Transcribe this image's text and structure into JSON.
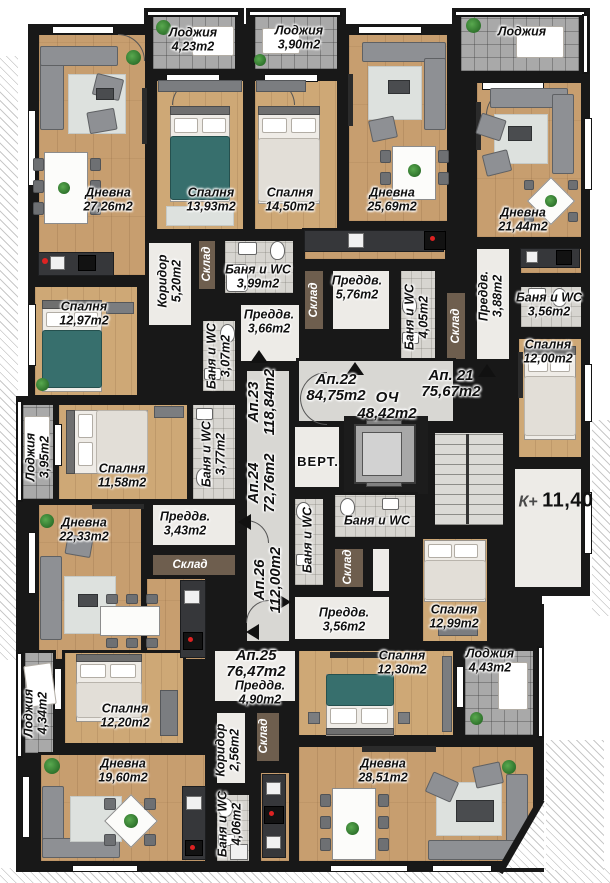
{
  "level": {
    "prefix": "К+",
    "value": "11,40"
  },
  "rooms": [
    {
      "name": "Лоджия",
      "area": "4,23m2"
    },
    {
      "name": "Дневна",
      "area": "27,26m2"
    },
    {
      "name": "Спалня",
      "area": "13,93m2"
    },
    {
      "name": "Спалня",
      "area": "14,50m2"
    },
    {
      "name": "Лоджия",
      "area": "3,90m2"
    },
    {
      "name": "Дневна",
      "area": "25,69m2"
    },
    {
      "name": "Лоджия"
    },
    {
      "name": "Дневна",
      "area": "21,44m2"
    },
    {
      "name": "Спалня",
      "area": "12,97m2"
    },
    {
      "name": "Коридор",
      "area": "5,20m2"
    },
    {
      "name": "Склад"
    },
    {
      "name": "Баня и WC",
      "area": "3,99m2"
    },
    {
      "name": "Преддв.",
      "area": "3,66m2"
    },
    {
      "name": "Баня и WC",
      "area": "3,07m2"
    },
    {
      "name": "Преддв.",
      "area": "5,76m2"
    },
    {
      "name": "Склад"
    },
    {
      "name": "Баня и WC",
      "area": "4,05m2"
    },
    {
      "name": "Склад"
    },
    {
      "name": "Преддв.",
      "area": "3,88m2"
    },
    {
      "name": "Баня и WC",
      "area": "3,56m2"
    },
    {
      "name": "Спалня",
      "area": "12,00m2"
    },
    {
      "name": "Ап.22",
      "area": "84,75m2"
    },
    {
      "name": "ОЧ",
      "area": "48,42m2"
    },
    {
      "name": "Ап. 21",
      "area": "75,67m2"
    },
    {
      "name": "Ап.23",
      "area": "118,84m2"
    },
    {
      "name": "Ап.24",
      "area": "72,76m2"
    },
    {
      "name": "Лоджия",
      "area": "3,95m2"
    },
    {
      "name": "Спалня",
      "area": "11,58m2"
    },
    {
      "name": "Баня и WC",
      "area": "3,77m2"
    },
    {
      "name": "ВЕРТ."
    },
    {
      "name": "Дневна",
      "area": "22,33m2"
    },
    {
      "name": "Преддв.",
      "area": "3,43m2"
    },
    {
      "name": "Склад"
    },
    {
      "name": "Баня и WC"
    },
    {
      "name": "Баня и WC"
    },
    {
      "name": "Склад"
    },
    {
      "name": "Ап.26",
      "area": "112,00m2"
    },
    {
      "name": "Спалня",
      "area": "12,99m2"
    },
    {
      "name": "Преддв.",
      "area": "3,56m2"
    },
    {
      "name": "Спалня",
      "area": "12,30m2"
    },
    {
      "name": "Лоджия",
      "area": "4,43m2"
    },
    {
      "name": "Ап.25",
      "area": "76,47m2"
    },
    {
      "name": "Преддв.",
      "area": "4,90m2"
    },
    {
      "name": "Лоджия",
      "area": "4,34m2"
    },
    {
      "name": "Спалня",
      "area": "12,20m2"
    },
    {
      "name": "Дневна",
      "area": "19,60m2"
    },
    {
      "name": "Коридор",
      "area": "2,56m2"
    },
    {
      "name": "Склад"
    },
    {
      "name": "Баня и WC",
      "area": "4,06m2"
    },
    {
      "name": "Дневна",
      "area": "28,51m2"
    }
  ],
  "colors": {
    "wall": "#181818",
    "wood": "#c79e6f",
    "loggia_tile": "#a9a9a9",
    "bath_tile": "#d7d5d0",
    "bed_accent": "#376f6d"
  }
}
